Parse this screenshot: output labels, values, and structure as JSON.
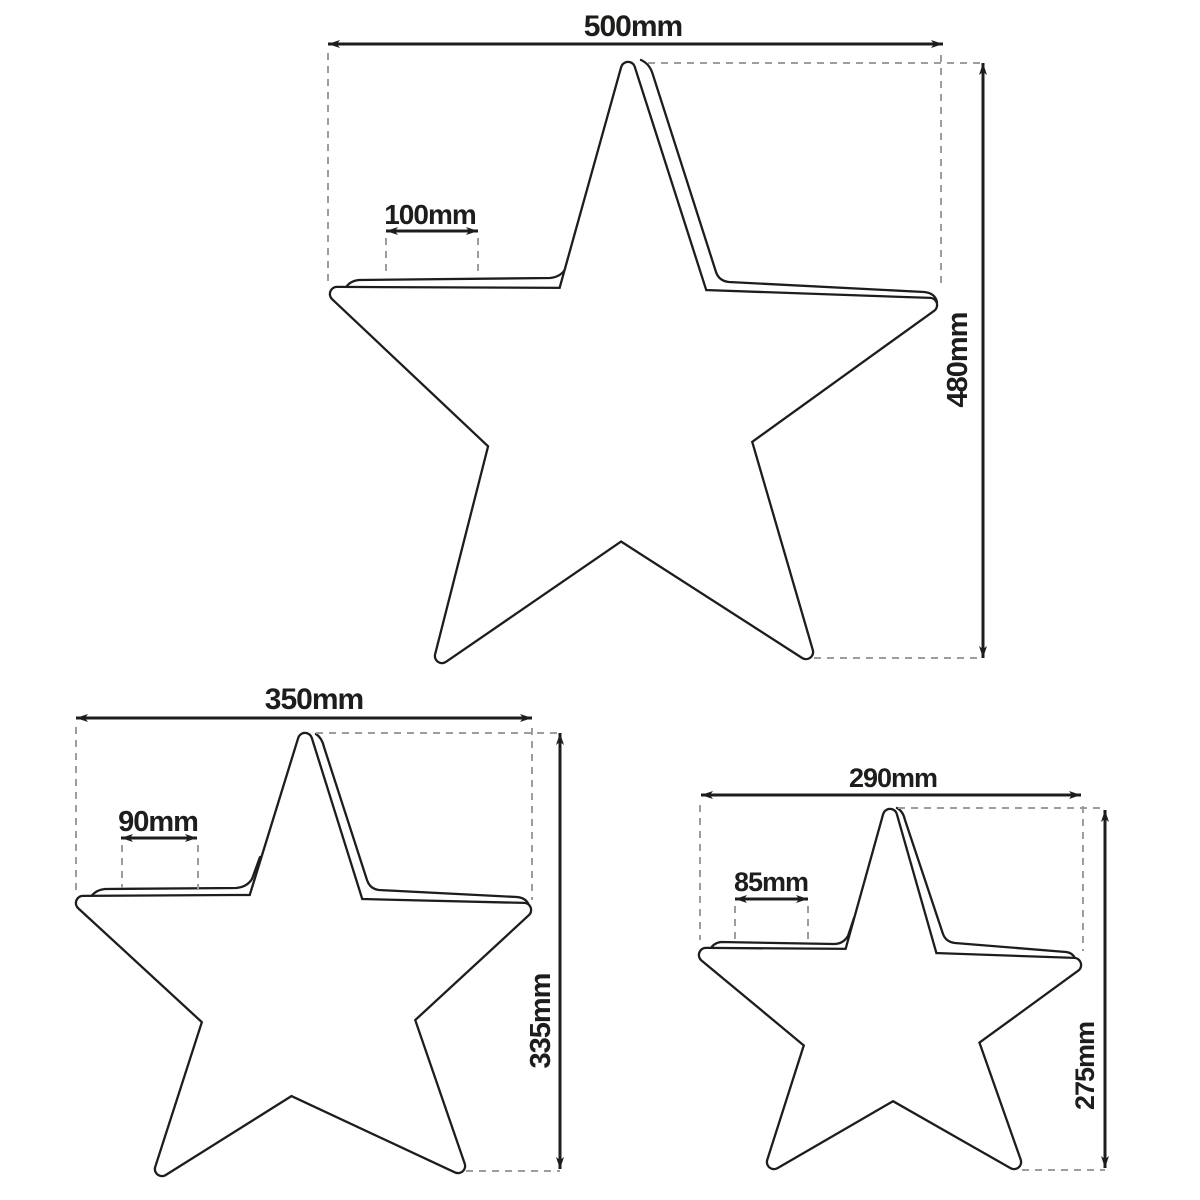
{
  "title": "Star lamp size comparison diagram",
  "colors": {
    "background": "#ffffff",
    "line": "#1d1d1b",
    "dash": "#9d9d9c"
  },
  "stars": [
    {
      "name": "large-star",
      "width": "500mm",
      "height": "480mm",
      "depth": "100mm"
    },
    {
      "name": "medium-star",
      "width": "350mm",
      "height": "335mm",
      "depth": "90mm"
    },
    {
      "name": "small-star",
      "width": "290mm",
      "height": "275mm",
      "depth": "85mm"
    }
  ]
}
